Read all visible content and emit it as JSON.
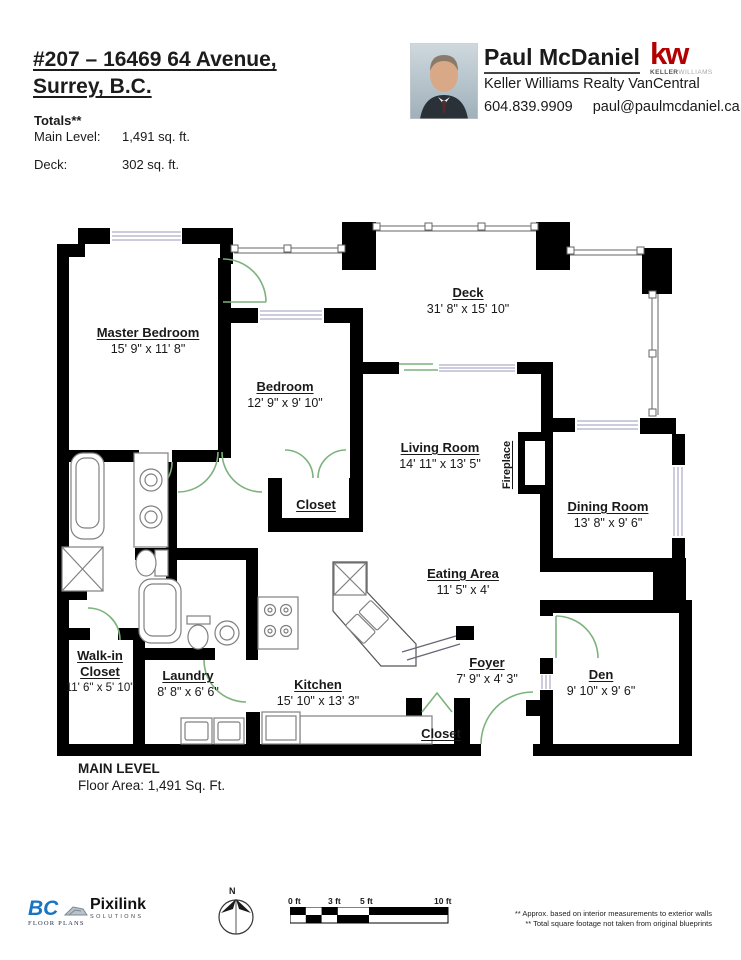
{
  "header": {
    "address_line1": "#207 – 16469 64 Avenue,",
    "address_line2": "Surrey, B.C.",
    "totals_title": "Totals**",
    "total_rows": [
      {
        "label": "Main Level:",
        "value": "1,491 sq. ft."
      },
      {
        "label": "Deck:",
        "value": "302 sq. ft."
      }
    ]
  },
  "agent": {
    "name": "Paul McDaniel",
    "brokerage": "Keller Williams Realty VanCentral",
    "phone": "604.839.9909",
    "email": "paul@paulmcdaniel.ca",
    "kw_mark": "kw",
    "kw_sub_bold": "KELLER",
    "kw_sub_light": "WILLIAMS"
  },
  "rooms": [
    {
      "name": "Master Bedroom",
      "dims": "15' 9\" x 11' 8\""
    },
    {
      "name": "Bedroom",
      "dims": "12' 9\" x 9' 10\""
    },
    {
      "name": "Deck",
      "dims": "31' 8\" x 15' 10\""
    },
    {
      "name": "Living Room",
      "dims": "14' 11\" x 13' 5\""
    },
    {
      "name": "Dining Room",
      "dims": "13' 8\" x 9' 6\""
    },
    {
      "name": "Eating Area",
      "dims": "11' 5\" x 4'"
    },
    {
      "name": "Foyer",
      "dims": "7' 9\" x 4' 3\""
    },
    {
      "name": "Den",
      "dims": "9' 10\" x 9' 6\""
    },
    {
      "name": "Walk-in Closet",
      "dims": "11' 6\" x 5' 10\""
    },
    {
      "name": "Laundry",
      "dims": "8' 8\" x 6' 6\""
    },
    {
      "name": "Kitchen",
      "dims": "15' 10\" x 13' 3\""
    },
    {
      "name": "Closet",
      "dims": ""
    },
    {
      "name": "Closet",
      "dims": ""
    },
    {
      "name": "Fireplace",
      "dims": ""
    }
  ],
  "plan_footer": {
    "level_title": "MAIN LEVEL",
    "area_text": "Floor Area: 1,491 Sq. Ft."
  },
  "footer": {
    "bc_text": "BC",
    "bc_sub": "FLOOR PLANS",
    "pixilink_text": "Pixilink",
    "pixilink_sub": "SOLUTIONS",
    "compass_label": "N",
    "scale_labels": [
      "0 ft",
      "3 ft",
      "5 ft",
      "10 ft"
    ],
    "disclaimer_line1": "** Approx. based on interior measurements to exterior walls",
    "disclaimer_line2": "** Total square footage not taken from original blueprints"
  },
  "colors": {
    "wall": "#000000",
    "door_green": "#7DB27D",
    "window_line": "#9A9AB8",
    "kw_red": "#B30000",
    "bc_blue": "#1B74C0"
  }
}
